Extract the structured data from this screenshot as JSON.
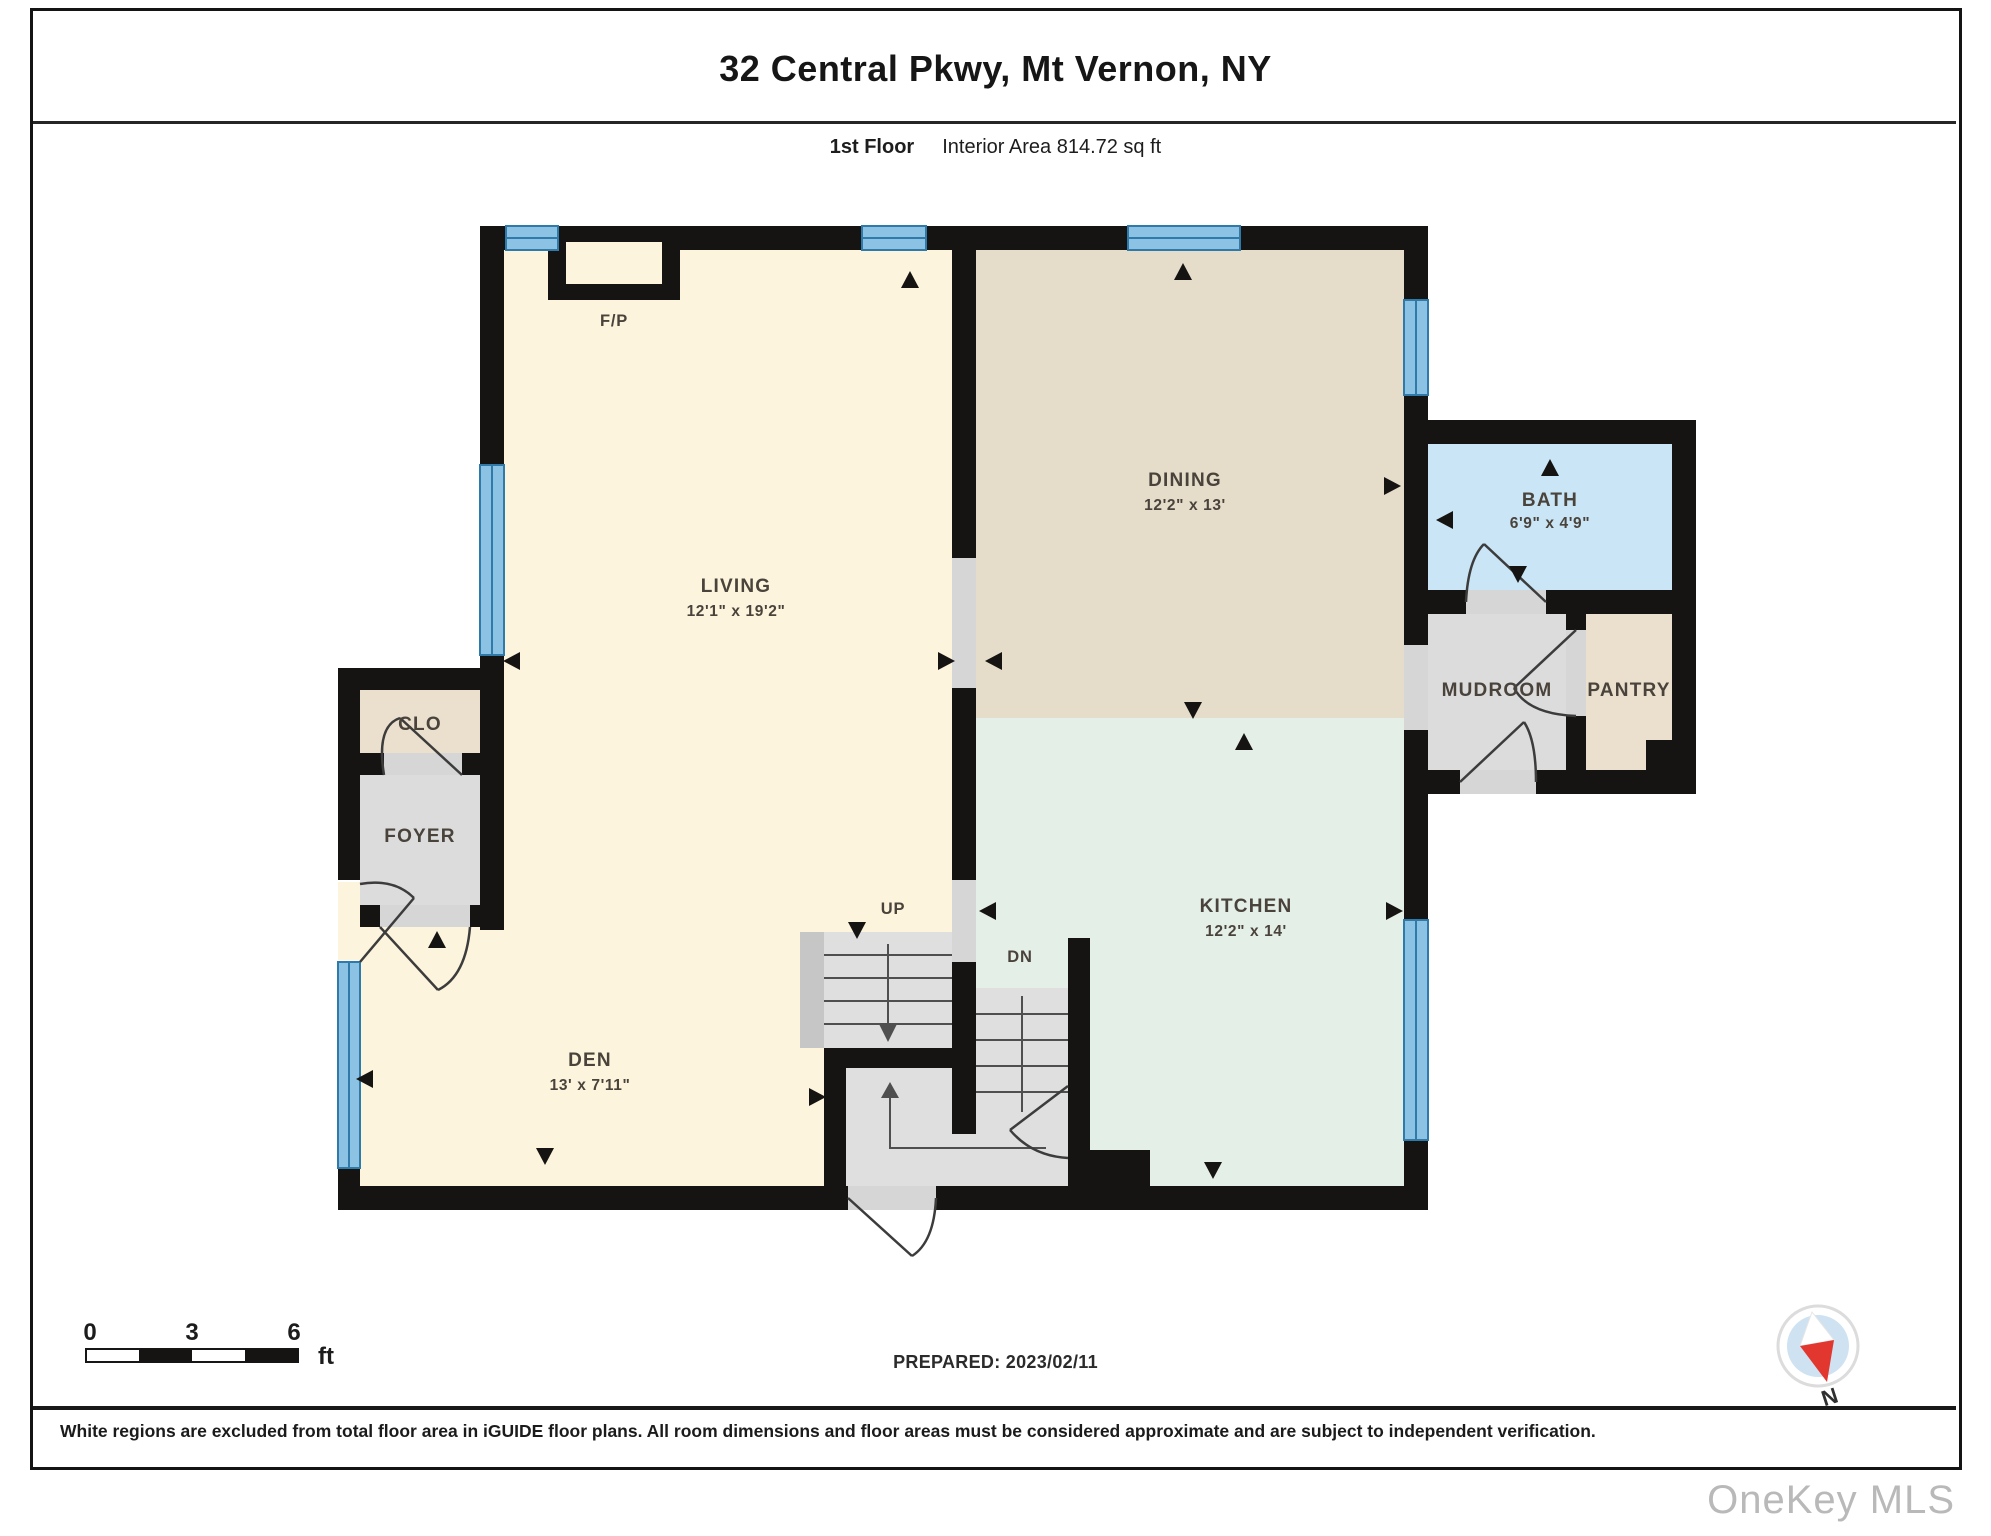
{
  "header": {
    "title": "32 Central Pkwy, Mt Vernon, NY",
    "floor_label": "1st Floor",
    "area_label": "Interior Area 814.72 sq ft"
  },
  "rooms": {
    "living": {
      "label": "LIVING",
      "dims": "12'1\" x 19'2\""
    },
    "dining": {
      "label": "DINING",
      "dims": "12'2\" x 13'"
    },
    "bath": {
      "label": "BATH",
      "dims": "6'9\" x 4'9\""
    },
    "mudroom": {
      "label": "MUDROOM"
    },
    "pantry": {
      "label": "PANTRY"
    },
    "kitchen": {
      "label": "KITCHEN",
      "dims": "12'2\" x 14'"
    },
    "clo": {
      "label": "CLO"
    },
    "foyer": {
      "label": "FOYER"
    },
    "den": {
      "label": "DEN",
      "dims": "13' x 7'11\""
    }
  },
  "labels": {
    "fireplace": "F/P",
    "up": "UP",
    "down": "DN"
  },
  "scale": {
    "n0": "0",
    "n3": "3",
    "n6": "6",
    "unit": "ft"
  },
  "footer": {
    "prepared": "PREPARED: 2023/02/11",
    "disclaimer": "White regions are excluded from total floor area in iGUIDE floor plans. All room dimensions and floor areas must be considered approximate and are subject to independent verification.",
    "watermark": "OneKey MLS",
    "north": "N"
  },
  "colors": {
    "wall": "#161412",
    "window": "#8cc3e4",
    "window_line": "#2f7aa8",
    "cream": "#fcf4dc",
    "dining_tan": "#e5dcca",
    "kitchen_green": "#e4efe7",
    "bath_blue": "#c9e5f6",
    "room_grey": "#dcdcdc",
    "pantry_tan": "#eae0cd",
    "stair_grey": "#dfdfdf",
    "stair_edge": "#c6c6c6",
    "opening_grey": "#d6d6d6",
    "label_text": "#4a433b",
    "compass_blue": "#cfe2f1",
    "compass_red": "#e2372f"
  }
}
